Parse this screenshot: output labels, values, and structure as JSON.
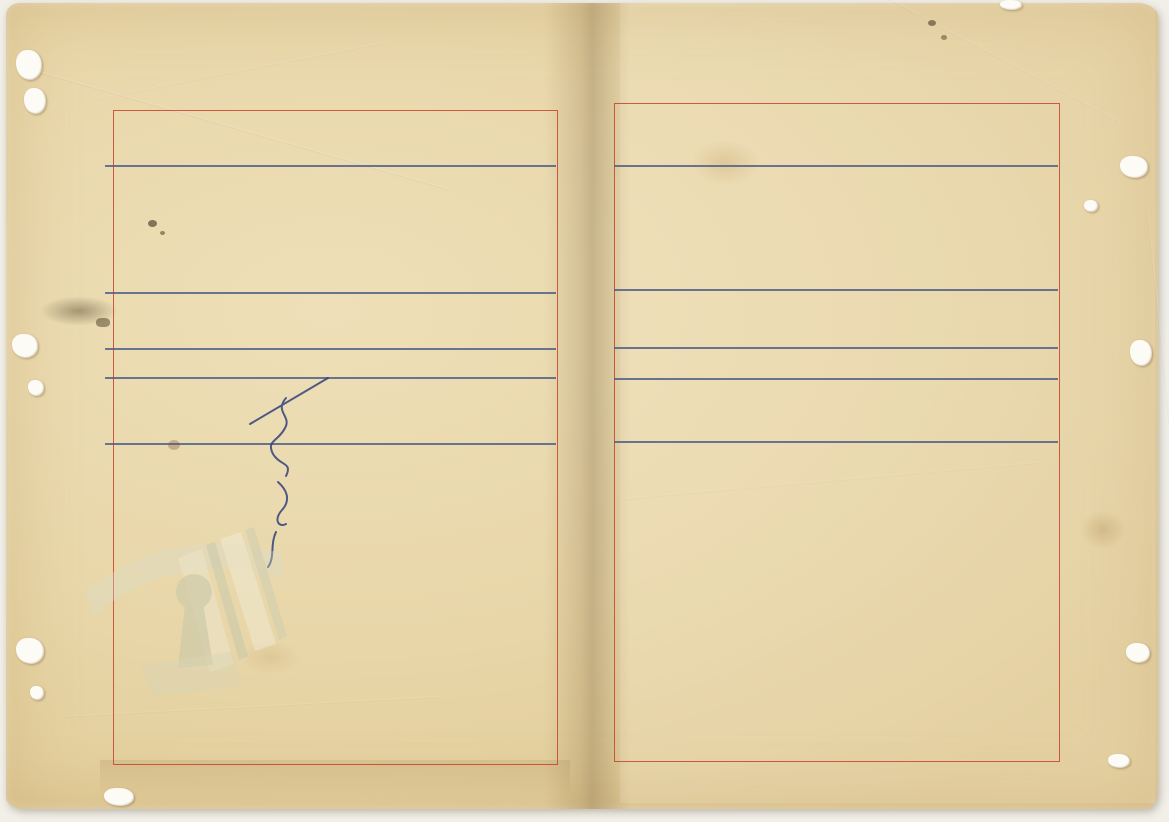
{
  "document": {
    "spine_agency": "臺灣警備總司令部",
    "page_label": {
      "prefix": "第",
      "number": "4",
      "suffix": "頁"
    },
    "archive_number_center": "0024",
    "archive_number_corner": "43",
    "footer_watermark": "請合法使用公開之影像"
  },
  "right_page": {
    "columns": [
      {
        "rank": "上士",
        "name": "涂以澤",
        "amount_upper": "一四",
        "amount_lower": "〇〇",
        "seal_text": "涂以澤印",
        "seal_style": "medium"
      },
      {
        "rank": "〃",
        "name": "沈関孝",
        "amount_upper": "一四",
        "amount_lower": "〇〇",
        "seal_text": "沈関孝印",
        "seal_style": "faint"
      },
      {
        "rank": "中士",
        "name": "馬錦明",
        "amount_upper": "一四",
        "amount_lower": "〇〇",
        "seal_text": "馬錦明印",
        "seal_style": "bright"
      },
      {
        "rank": "〃",
        "name": "丁樹德",
        "amount_upper": "一四",
        "amount_lower": "〇〇",
        "seal_text": "丁樹德印",
        "seal_style": "bright"
      },
      {
        "rank": "〃",
        "name": "孫仁忠",
        "amount_upper": "一四",
        "amount_lower": "〇〇",
        "seal_text": "孫仁忠印",
        "seal_style": "faint"
      },
      {
        "rank": "〃",
        "name": "鄭才基",
        "amount_upper": "一四",
        "amount_lower": "〇〇",
        "seal_text": "鄭才基印",
        "seal_style": "medium"
      },
      {
        "rank": "下士",
        "name": "余魁五",
        "amount_upper": "一四",
        "amount_lower": "〇〇",
        "seal_text": "余魁五印",
        "seal_style": "medium"
      },
      {
        "rank": "〃",
        "name": "蘇文章",
        "amount_upper": "一四",
        "amount_lower": "〇〇",
        "seal_text": "蘇文章印",
        "seal_style": "dark"
      },
      {
        "rank": "上士",
        "name": "梁永盛",
        "amount_upper": "一四",
        "amount_lower": "〇〇",
        "seal_text": "",
        "seal_style": "signature"
      },
      {
        "rank": "〃",
        "name": "王彦平",
        "amount_upper": "一四",
        "amount_lower": "〇〇",
        "seal_text": "王彦平印",
        "seal_style": "small"
      }
    ]
  },
  "left_page": {
    "columns": [
      {
        "rank": "下士",
        "name": "傅延春",
        "amount_upper": "一四",
        "amount_lower": "〇〇",
        "seal_text": "傅延春印",
        "seal_style": "bright"
      },
      {
        "rank": "〃",
        "name": "徐希彦",
        "amount_upper": "一四",
        "amount_lower": "〇〇",
        "seal_text": "徐希彦印",
        "seal_style": "dark"
      },
      {
        "rank": "〃",
        "name": "許心良",
        "amount_upper": "一四",
        "amount_lower": "〇〇",
        "seal_text": "許心良印",
        "seal_style": "faint"
      },
      {
        "rank": "〃",
        "name": "吳培揚",
        "amount_upper": "一四",
        "amount_lower": "〇〇",
        "seal_text": "吳培揚印",
        "seal_style": "medium"
      },
      {
        "rank": "〃",
        "name": "蔣元山",
        "amount_upper": "一四",
        "amount_lower": "〇〇",
        "seal_text": "蔣元山印",
        "seal_style": "medium"
      },
      {
        "rank": "〃",
        "name": "謝代華",
        "amount_upper": "一四",
        "amount_lower": "〇〇",
        "seal_text": "謝代華印",
        "seal_style": "medium"
      }
    ],
    "unit_label": "看守所",
    "unit_total_upper": "一〇五六",
    "unit_total_lower": "〇〇",
    "grand_total_label": "合計",
    "grand_total_upper": "五〇〇〇",
    "grand_total_lower": "〇〇",
    "margin_note": "含勤務隊蔡一生1名"
  }
}
